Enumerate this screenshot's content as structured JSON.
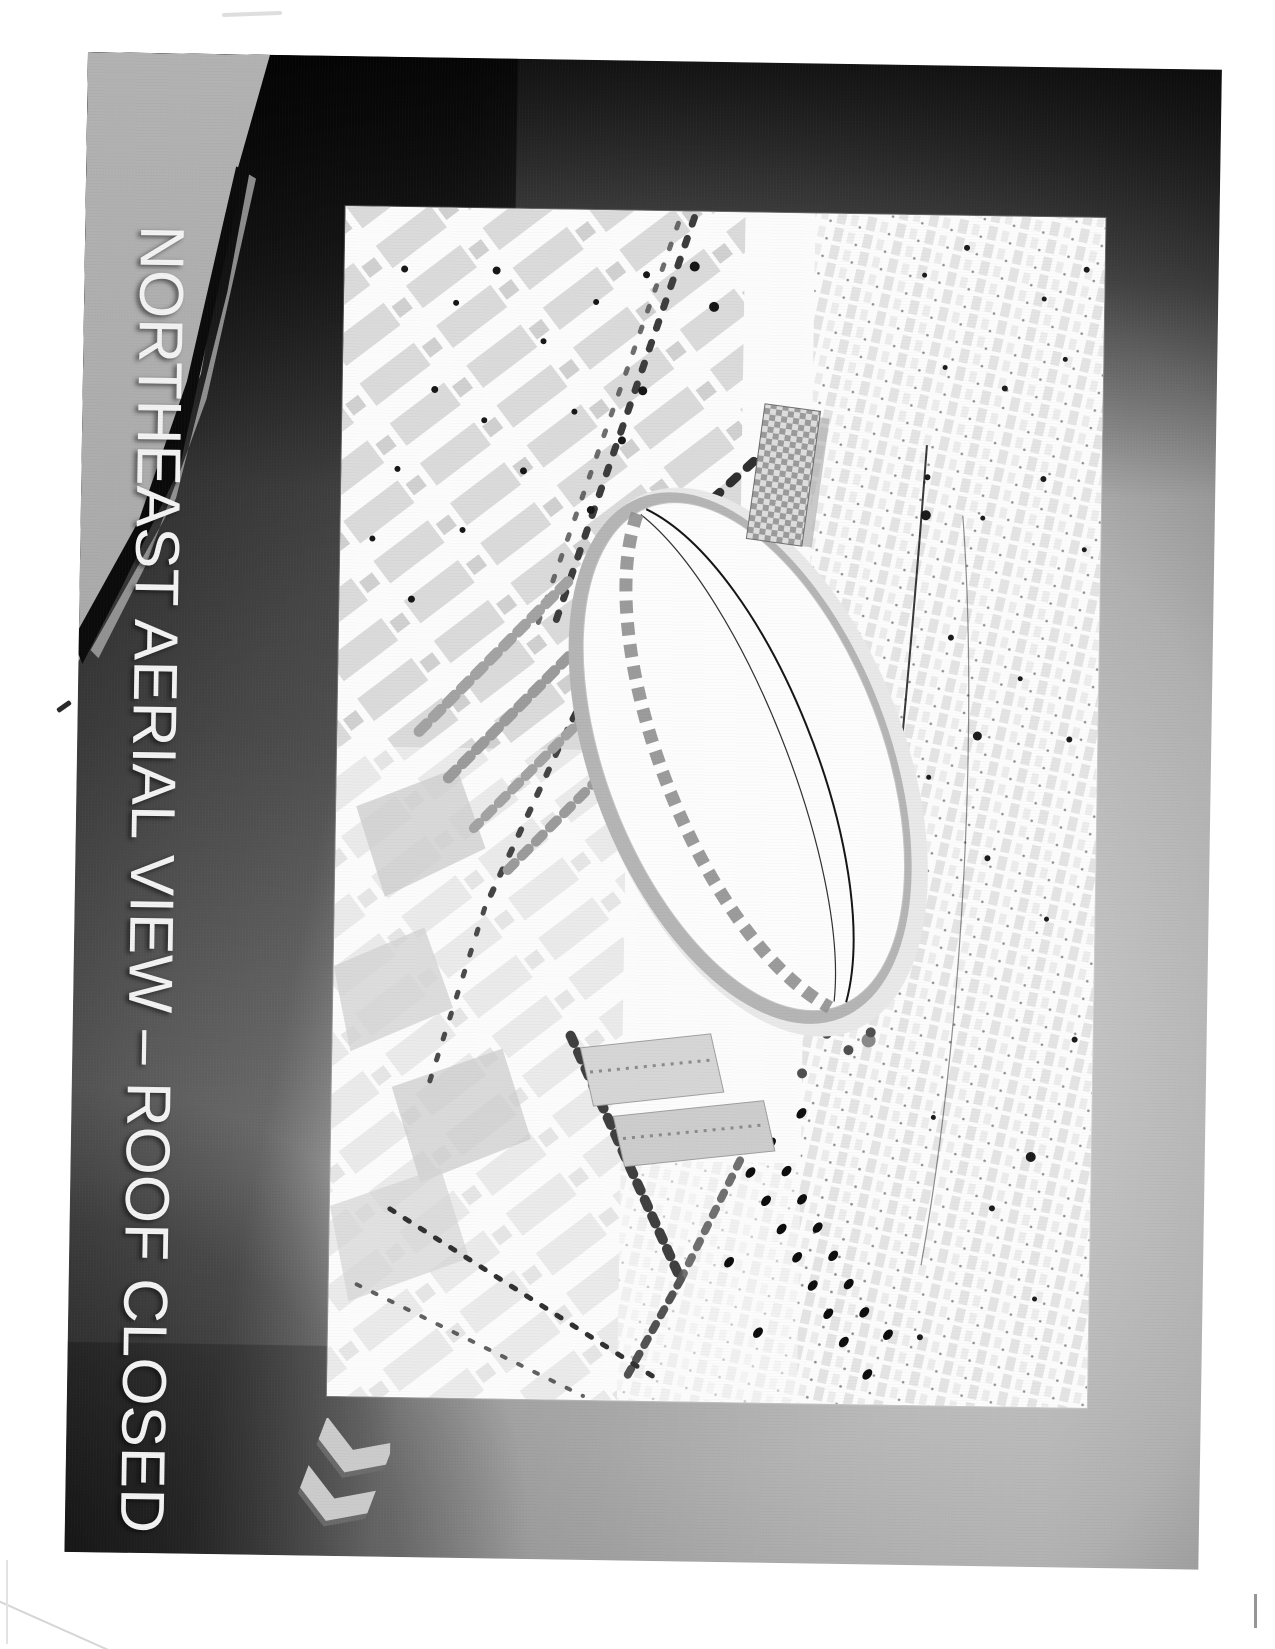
{
  "page": {
    "kind": "scanned presentation slide",
    "background_color": "#ffffff"
  },
  "slide": {
    "title": "NORTHEAST AERIAL VIEW – ROOF CLOSED",
    "title_color": "#f2f2f2",
    "accent_colors": {
      "corner_wedge_light": "#a9a9a9",
      "diagonal_stripe_black": "#0b0b0b",
      "background_dark": "#111111",
      "background_light": "#c9c9c9"
    },
    "icons": {
      "nav_icon": "double-chevron-icon",
      "nav_icon_direction": "down-left",
      "nav_icon_color": "#cbcbcb"
    },
    "picture": {
      "name": "stadium-aerial-rendering",
      "alt": "Grayscale aerial rendering of a stadium with closed white roof surrounded by city blocks, plazas and tree-lined streets"
    }
  }
}
